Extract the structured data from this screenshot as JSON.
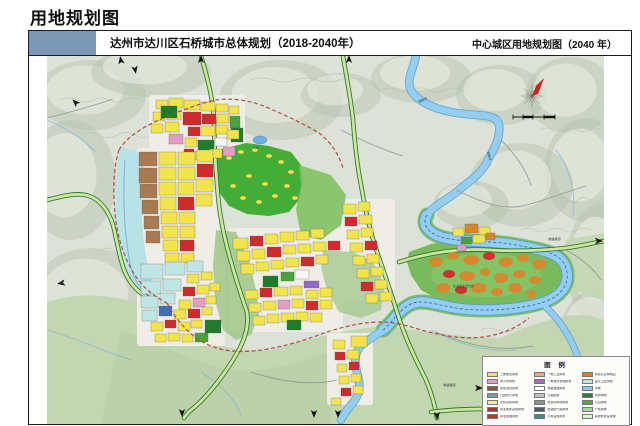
{
  "page": {
    "title": "用地规划图"
  },
  "sheet": {
    "header": {
      "accent_color": "#7a98b4",
      "left_title": "达州市达川区石桥城市总体规划（2018-2040年）",
      "right_title": "中心城区用地规划图（2040 年）"
    }
  },
  "legend": {
    "title": "图 例",
    "columns": [
      [
        {
          "color": "#f2e354",
          "label": "二类居住用地"
        },
        {
          "color": "#e79ec6",
          "label": "中小学用地"
        },
        {
          "color": "#a8453e",
          "label": "商住混合用地"
        },
        {
          "color": "#8096b6",
          "label": "行政办公用地"
        },
        {
          "color": "#f5ed7c",
          "label": "文化设施用地"
        },
        {
          "color": "#9e3b36",
          "label": "商业服务设施用地"
        },
        {
          "color": "#d2262a",
          "label": "商业金融用地"
        }
      ],
      [
        {
          "color": "#e3b079",
          "label": "一类工业用地"
        },
        {
          "color": "#9a6fc4",
          "label": "一类物流仓储用地"
        },
        {
          "color": "#ffffff",
          "label": "预留发展用地"
        },
        {
          "color": "#c2c2c2",
          "label": "公路用地"
        },
        {
          "color": "#8f8f8f",
          "label": "社会停车场用地"
        },
        {
          "color": "#4f5b66",
          "label": "加油加气站用地"
        },
        {
          "color": "#3a8f8a",
          "label": "公用设施用地"
        }
      ],
      [
        {
          "color": "#d9822b",
          "label": "特色农业种植园"
        },
        {
          "color": "#bfe6e8",
          "label": "医疗卫生用地"
        },
        {
          "color": "#8ec6ea",
          "label": "水域"
        },
        {
          "color": "#2e7d32",
          "label": "防护绿地"
        },
        {
          "color": "#55a848",
          "label": "公园绿地"
        },
        {
          "color": "#a8d6a0",
          "label": "广场用地"
        },
        {
          "color": "#e4efe0",
          "label": "其他非建设用地"
        }
      ]
    ]
  },
  "annotations": [
    {
      "text": "铜钵河"
    },
    {
      "text": "铜钵河"
    },
    {
      "text": "生态农业观光园"
    },
    {
      "text": "（快速通道）"
    },
    {
      "text": "水库"
    },
    {
      "text": "（快速通道）"
    }
  ],
  "palette": {
    "terrain": "#dde2d8",
    "hill": "#b6c0ac",
    "hill2": "#c9d0c0",
    "ridge": "#edf0e8",
    "lowland": "#c3d6b2",
    "lowland2": "#b4cda3",
    "park": "#44ad38",
    "park2": "#7cbf5e",
    "peninsula": "#79ba5c",
    "riverEdge": "#5e9fc9",
    "river": "#93cdef",
    "riverGreen": "#7fbf63",
    "cyanband": "#b8e2e6",
    "urbanBase": "#efeee6",
    "Y": "#f3e34c",
    "R": "#cf2b2c",
    "R2": "#a93b34",
    "PK": "#e49cc2",
    "BR": "#a87a50",
    "C": "#bfe6e4",
    "B": "#3c6fbd",
    "PU": "#9468c8",
    "W": "#f7f7f3",
    "DG": "#1f7c2b",
    "G2": "#49a33c",
    "OR": "#d8862c",
    "boundary": "#b5433b",
    "navline": "#2a55a8",
    "roads": "#8a948a",
    "compassRed": "#d42015"
  }
}
